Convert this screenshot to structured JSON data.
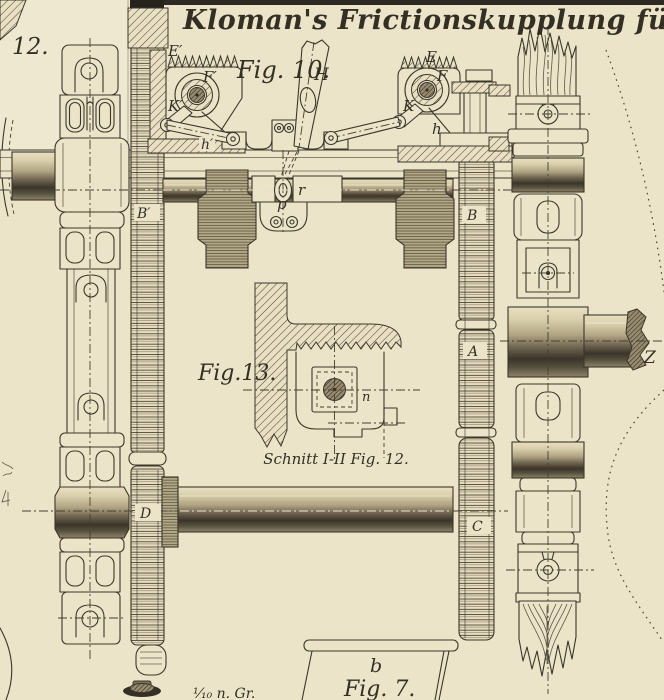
{
  "plate": {
    "title": "Kloman's Frictionskupplung für Reversir",
    "scale_note": "¹⁄₁₀ n. Gr.",
    "paper_color": "#ece4c8",
    "ink_color": "#3b362a"
  },
  "figures": {
    "fig12_label": "12.",
    "fig10_label": "Fig. 10.",
    "fig13_label": "Fig.13.",
    "fig13_caption": "Schnitt I-II Fig. 12.",
    "fig7_label": "Fig. 7.",
    "fig7_part_label": "b"
  },
  "parts": {
    "e_prime": "E′",
    "f_prime": "F′",
    "k_prime": "K′",
    "h_prime": "h′",
    "lever": "H",
    "e": "E",
    "f": "F",
    "k": "K",
    "h": "h",
    "b_prime": "B′",
    "b": "B",
    "a": "A",
    "c": "C",
    "d": "D",
    "r": "r",
    "p": "p",
    "n": "n",
    "z": "Z"
  }
}
